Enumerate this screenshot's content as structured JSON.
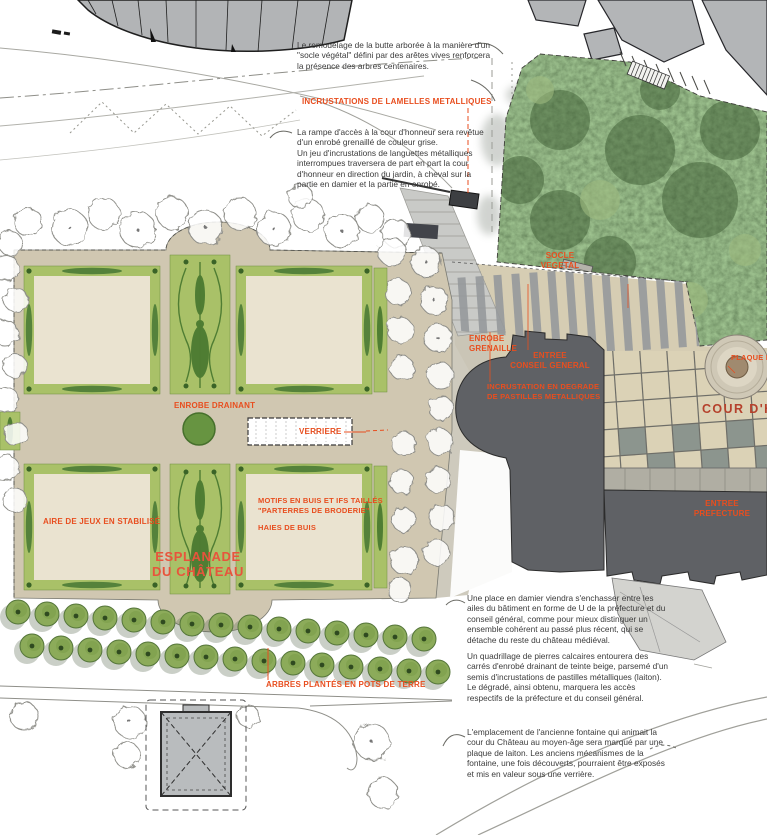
{
  "plan": {
    "paragraphs": {
      "butte": "Le remodelage de la butte arborée à la manière d'un\n\"socle végétal\" défini par des arêtes vives renforcera\nla présence des arbres centenaires.",
      "rampe": "La rampe d'accès à la cour d'honneur sera revêtue\nd'un enrobé grenaillé de couleur grise.\nUn jeu d'incrustations de languettes métalliques\ninterrompues traversera de part en part la cour\nd'honneur en direction du jardin, à cheval sur la\npartie en damier et la partie en enrobé.",
      "damier": "Une place en damier viendra s'enchasser entre les\nailes du bâtiment en forme de U de la préfecture et du\nconseil général, comme pour mieux distinguer un\nensemble cohérent au passé plus récent, qui se\ndétache du reste du château médiéval.",
      "quadrillage": "Un quadrillage de pierres calcaires entourera des\ncarrés d'enrobé drainant de teinte beige, parsemé d'un\nsemis d'incrustations de pastilles métalliques (laiton).\nLe dégradé, ainsi obtenu, marquera les accès\nrespectifs de la préfecture et du conseil général.",
      "fontaine": "L'emplacement de l'ancienne fontaine qui animait la\ncour du Château au moyen-âge sera marqué par une\nplaque de laiton. Les anciens mécanismes de la\nfontaine, une fois découverts, pourraient être exposés\net mis en valeur sous une verrière."
    },
    "labels": {
      "incrustations_lamelles": "INCRUSTATIONS DE LAMELLES METALLIQUES",
      "socle_vegetal": "SOCLE\nVEGETAL",
      "enrobe_grenaille": "ENROBE\nGRENAILLE",
      "entree_conseil": "ENTREE\nCONSEIL GENERAL",
      "incrustation_degrade": "INCRUSTATION EN DEGRADE\nDE PASTILLES METALLIQUES",
      "plaque_metallique": "PLAQUE ME\nEMPLACEM",
      "cour_honneur": "COUR D'HON",
      "enrobe_drainant": "ENROBE DRAINANT",
      "verriere": "VERRIERE",
      "motifs_buis": "MOTIFS EN BUIS ET IFS TAILLÉS\n\"PARTERRES DE BRODERIE\"",
      "haies_buis": "HAIES DE BUIS",
      "aire_jeux": "AIRE DE JEUX EN STABILISÉ",
      "esplanade": "ESPLANADE\nDU CHÂTEAU",
      "entree_prefecture": "ENTREE\nPREFECTURE",
      "arbres_pots": "ARBRES PLANTÉS EN POTS DE TERRE"
    },
    "colors": {
      "label_red": "#e84e1f",
      "cour_red": "#b5412c",
      "esplanade_red": "#e8543c",
      "text_dark": "#3b3b3b",
      "building_dark": "#5f6165",
      "building_light": "#b3b5b7",
      "parterre_cream": "#eae3d0",
      "frame_green": "#a9c168",
      "motif_green": "#4f7d33",
      "path_beige": "#d2c9b2",
      "foliage_green": "#6d8d58"
    }
  }
}
